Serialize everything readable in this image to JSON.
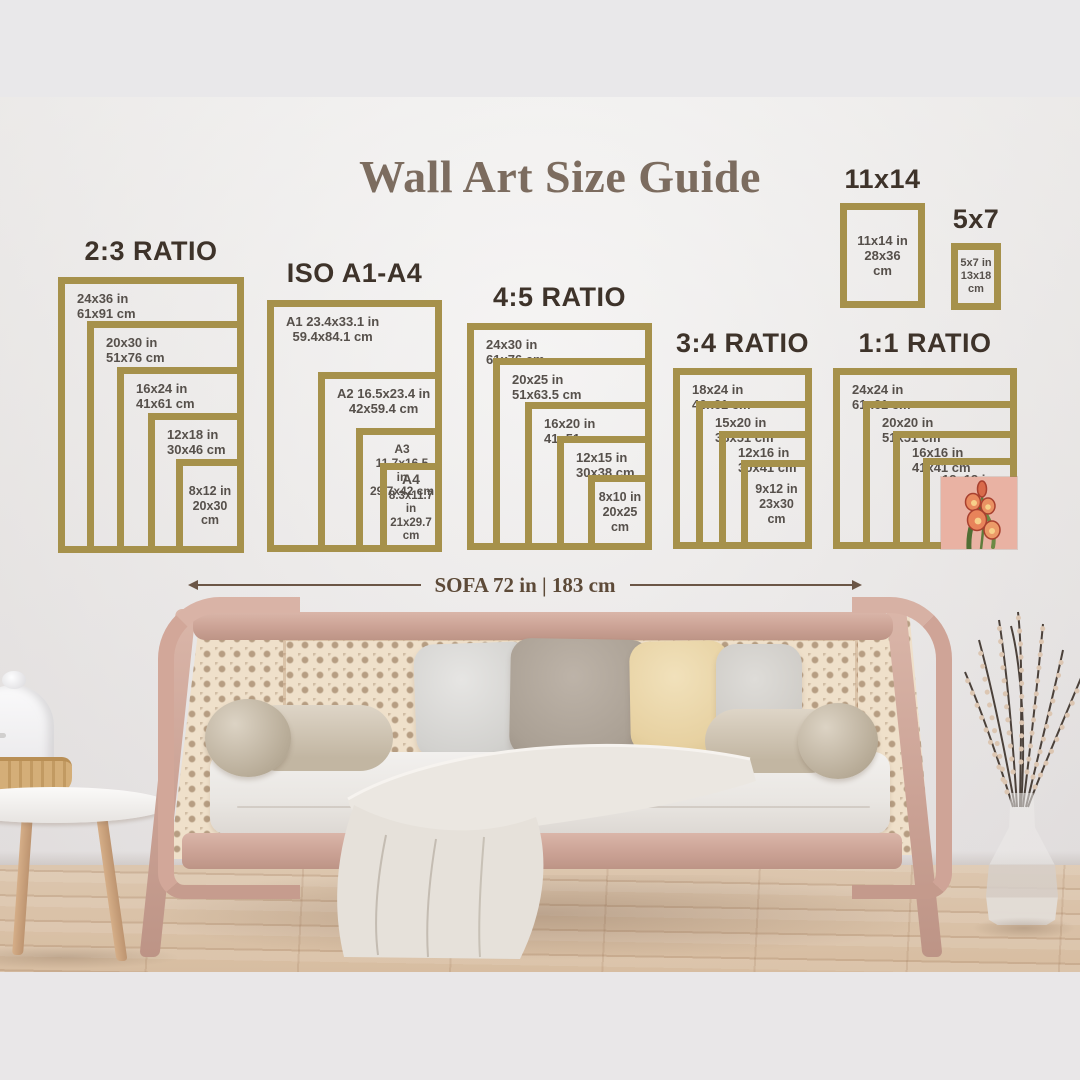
{
  "title": "Wall Art Size Guide",
  "measure": {
    "label": "SOFA 72 in | 183 cm"
  },
  "palette": {
    "frame_gold": "#a6914b",
    "heading_text": "#3e332a",
    "label_text": "#56504b",
    "title_text": "#7c6c5f",
    "measure_text": "#5d4a38",
    "art_background": "#e9b2a3"
  },
  "art_print": {
    "subject": "gladiolus flower print"
  },
  "guide": {
    "groups": [
      {
        "header": "2:3 RATIO",
        "frames": [
          {
            "lines": [
              "24x36 in",
              "61x91 cm"
            ]
          },
          {
            "lines": [
              "20x30 in",
              "51x76 cm"
            ]
          },
          {
            "lines": [
              "16x24 in",
              "41x61 cm"
            ]
          },
          {
            "lines": [
              "12x18 in",
              "30x46 cm"
            ]
          },
          {
            "lines": [
              "8x12 in",
              "20x30",
              "cm"
            ]
          }
        ]
      },
      {
        "header": "ISO A1-A4",
        "frames": [
          {
            "lines": [
              "A1 23.4x33.1 in",
              "59.4x84.1 cm"
            ]
          },
          {
            "lines": [
              "A2 16.5x23.4 in",
              "42x59.4 cm"
            ]
          },
          {
            "lines": [
              "A3 11.7x16.5 in",
              "29.7x42 cm"
            ]
          },
          {
            "lines": [
              "A4",
              "8.3x11.7 in",
              "21x29.7",
              "cm"
            ]
          }
        ]
      },
      {
        "header": "4:5 RATIO",
        "frames": [
          {
            "lines": [
              "24x30 in",
              "61x76 cm"
            ]
          },
          {
            "lines": [
              "20x25 in",
              "51x63.5 cm"
            ]
          },
          {
            "lines": [
              "16x20 in",
              "41x51 cm"
            ]
          },
          {
            "lines": [
              "12x15 in",
              "30x38 cm"
            ]
          },
          {
            "lines": [
              "8x10 in",
              "20x25",
              "cm"
            ]
          }
        ]
      },
      {
        "header": "3:4 RATIO",
        "frames": [
          {
            "lines": [
              "18x24 in",
              "46x61 cm"
            ]
          },
          {
            "lines": [
              "15x20 in",
              "38x51 cm"
            ]
          },
          {
            "lines": [
              "12x16 in",
              "30x41 cm"
            ]
          },
          {
            "lines": [
              "9x12 in",
              "23x30",
              "cm"
            ]
          }
        ]
      },
      {
        "header": "1:1 RATIO",
        "frames": [
          {
            "lines": [
              "24x24 in",
              "61x61 cm"
            ]
          },
          {
            "lines": [
              "20x20 in",
              "51x51 cm"
            ]
          },
          {
            "lines": [
              "16x16 in",
              "41x41 cm"
            ]
          },
          {
            "lines": [
              "12x12 in",
              "30x30 cm"
            ]
          }
        ]
      },
      {
        "header": "11x14",
        "frames": [
          {
            "lines": [
              "11x14 in",
              "28x36",
              "cm"
            ]
          }
        ]
      },
      {
        "header": "5x7",
        "frames": [
          {
            "lines": [
              "5x7 in",
              "13x18",
              "cm"
            ]
          }
        ]
      }
    ]
  }
}
